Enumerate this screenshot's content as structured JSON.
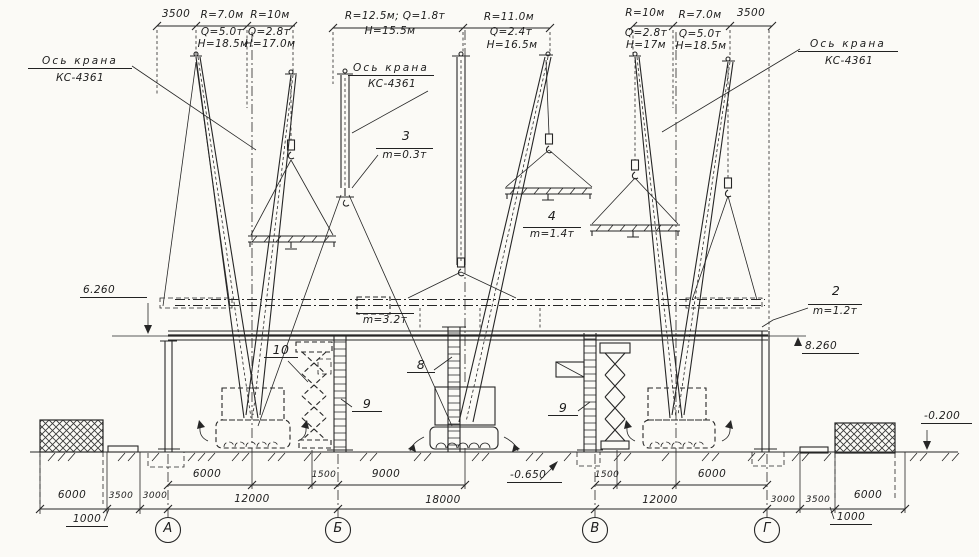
{
  "crane_axis_labels": {
    "left": {
      "line1": "Ось крана",
      "line2": "КС-4361"
    },
    "middle": {
      "line1": "Ось крана",
      "line2": "КС-4361"
    },
    "right": {
      "line1": "Ось крана",
      "line2": "КС-4361"
    }
  },
  "top_dims": {
    "left_3500": "3500",
    "pos1": {
      "r": "R=7.0м",
      "q": "Q=5.0т",
      "h": "Н=18.5м"
    },
    "pos2": {
      "r": "R=10м",
      "q": "Q=2.8т",
      "h": "Н=17.0м"
    },
    "pos3": {
      "rq": "R=12.5м; Q=1.8т",
      "h": "Н=15.5м"
    },
    "pos4": {
      "r": "R=11.0м",
      "q": "Q=2.4т",
      "h": "Н=16.5м"
    },
    "pos5": {
      "r": "R=10м",
      "q": "Q=2.8т",
      "h": "Н=17м"
    },
    "pos6": {
      "r": "R=7.0м",
      "q": "Q=5.0т",
      "h": "Н=18.5м"
    },
    "right_3500": "3500"
  },
  "items": {
    "item2": {
      "num": "2",
      "mass": "m=1.2т"
    },
    "item3": {
      "num": "3",
      "mass": "m=0.3т"
    },
    "item4": {
      "num": "4",
      "mass": "m=1.4т"
    },
    "truss_mass": "m=3.2т",
    "item8": "8",
    "item9_left": "9",
    "item9_right": "9",
    "item10": "10"
  },
  "elevations": {
    "beam_left": "6.260",
    "beam_right": "8.260",
    "pit": "-0.650",
    "ground_right": "-0.200"
  },
  "dims_inner": [
    "6000",
    "1500",
    "9000",
    "1500",
    "6000"
  ],
  "dims_spans": [
    "12000",
    "18000",
    "12000"
  ],
  "dims_left_outer": [
    "6000",
    "3500",
    "3000"
  ],
  "dims_right_outer": [
    "3000",
    "3500",
    "6000"
  ],
  "offsets": {
    "left": "1000",
    "right": "1000"
  },
  "axes": [
    "А",
    "Б",
    "В",
    "Г"
  ]
}
